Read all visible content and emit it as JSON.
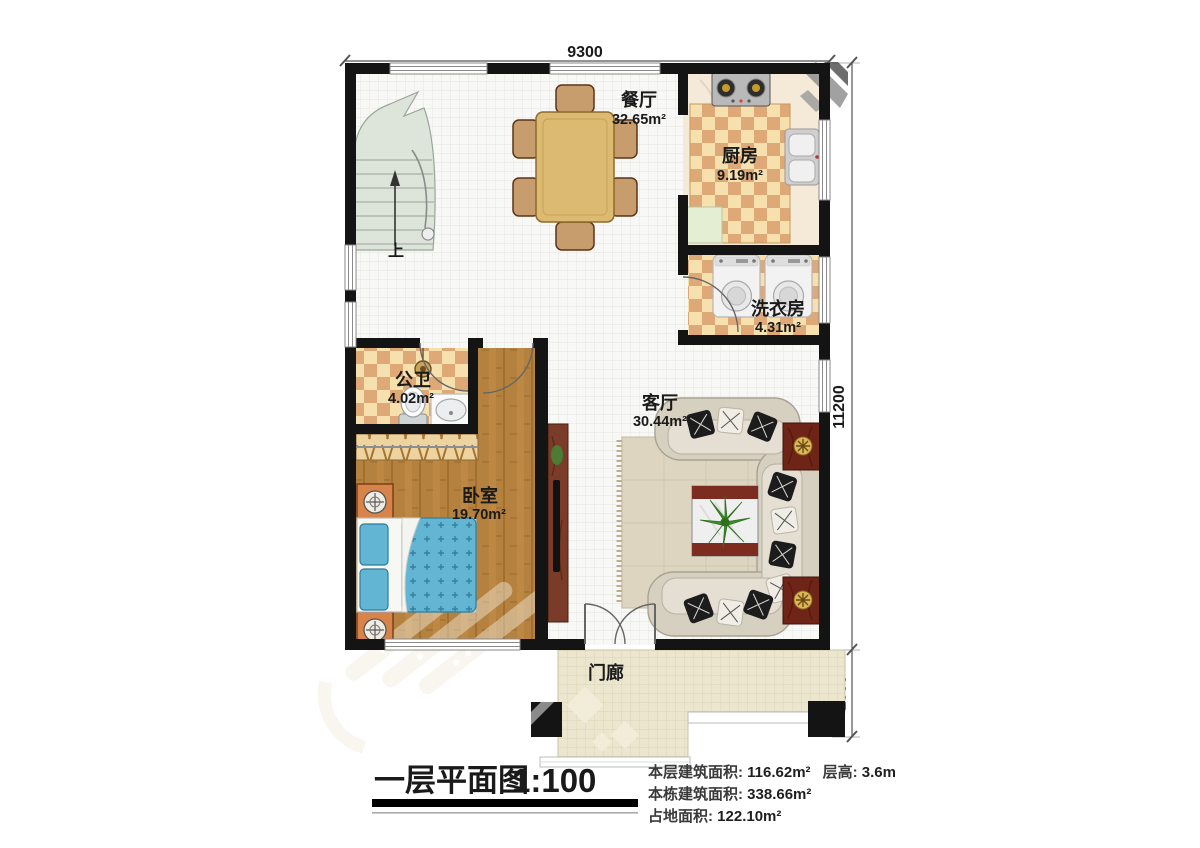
{
  "plan": {
    "dimensions": {
      "width_mm": "9300",
      "height_mm": "11200",
      "porch_mm": "1600"
    },
    "rooms": {
      "dining": {
        "name": "餐厅",
        "area": "32.65m²"
      },
      "kitchen": {
        "name": "厨房",
        "area": "9.19m²"
      },
      "laundry": {
        "name": "洗衣房",
        "area": "4.31m²"
      },
      "bathroom": {
        "name": "公卫",
        "area": "4.02m²"
      },
      "bedroom": {
        "name": "卧室",
        "area": "19.70m²"
      },
      "living": {
        "name": "客厅",
        "area": "30.44m²"
      },
      "porch": {
        "name": "门廊"
      }
    },
    "stairs": {
      "direction_label": "上"
    }
  },
  "legend": {
    "title": "一层平面图",
    "scale": "1:100",
    "stats": [
      {
        "label": "本层建筑面积: ",
        "value": "116.62m²",
        "label2": "层高: ",
        "value2": "3.6m"
      },
      {
        "label": "本栋建筑面积: ",
        "value": "338.66m²"
      },
      {
        "label": "占地面积: ",
        "value": "122.10m²"
      }
    ]
  },
  "colors": {
    "wall": "#141414",
    "tile_base": "#f8f8f6",
    "checker_cream": "#f6e0ae",
    "checker_tan": "#dfa977",
    "wood": "#b5813f",
    "bed_blue": "#62b6d4",
    "cabinet_red": "#6e2417",
    "porch_tile": "#ebe6cd",
    "marble": "#f4ead7",
    "counter_green": "#e4eed3",
    "sofa_body": "#d6d0c0",
    "rug": "#ddd5c0",
    "stair_fill": "#dde4da"
  }
}
